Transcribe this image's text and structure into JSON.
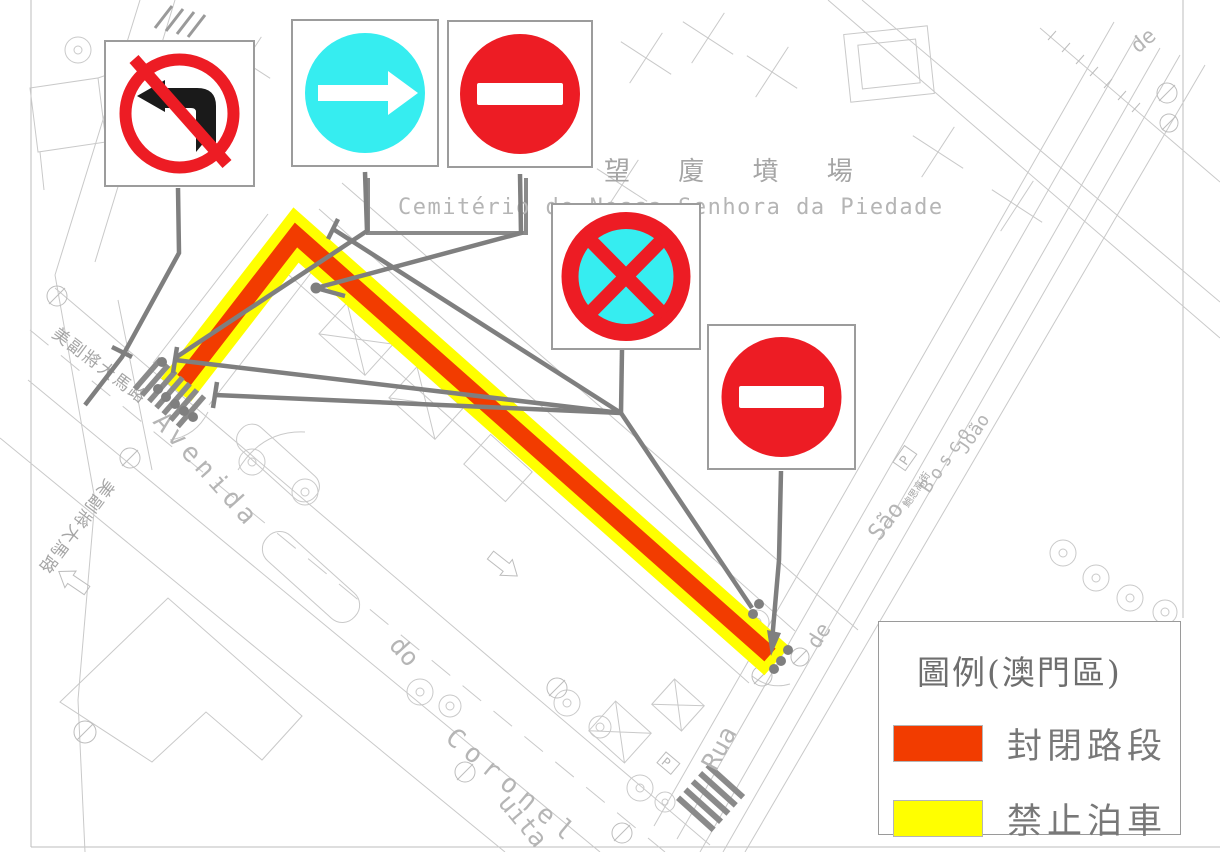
{
  "colors": {
    "closed_road": "#F23C00",
    "no_parking": "#FFFF00",
    "sign_red": "#ED1C24",
    "sign_cyan": "#36EDF0",
    "sign_black": "#1a1a1a",
    "leader_gray": "#7F7F7F",
    "linework_gray": "#C9C9C9"
  },
  "legend": {
    "title": "圖例(澳門區)",
    "items": [
      {
        "label": "封閉路段",
        "color": "#F23C00"
      },
      {
        "label": "禁止泊車",
        "color": "#FFFF00"
      }
    ]
  },
  "labels": {
    "cemetery_cn": "望 廈 墳 場",
    "cemetery_pt": "Cemitério de Nossa Senhora da Piedade",
    "mesquita_cn": "美副將大馬路",
    "avenida": "Avenida",
    "do": "do",
    "coronel": "Coronel",
    "mesquita_part": "uita",
    "rua": "Rua",
    "de": "de",
    "sao": "São",
    "joao": "João",
    "bosco": "Bosco",
    "bosco_cn": "鮑思高街",
    "parking": "P"
  },
  "signs": [
    {
      "name": "no-left-turn"
    },
    {
      "name": "mandatory-turn-right"
    },
    {
      "name": "no-entry"
    },
    {
      "name": "no-stopping"
    },
    {
      "name": "no-entry"
    }
  ]
}
